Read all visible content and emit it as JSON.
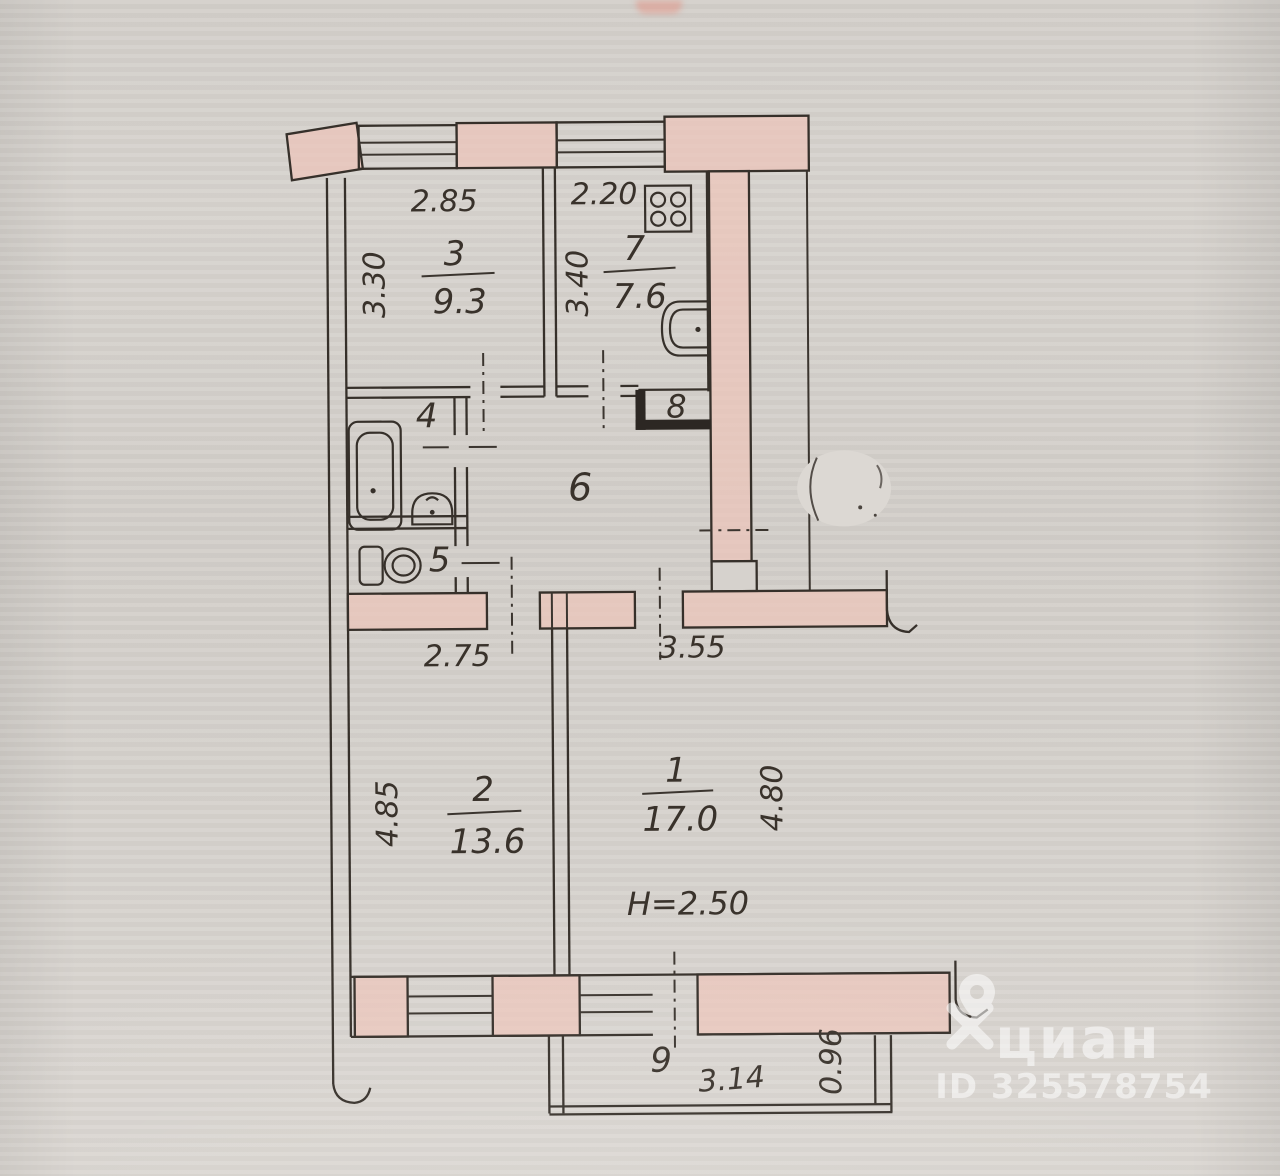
{
  "plan": {
    "rooms": {
      "room_1": {
        "number": "1",
        "area": "17.0",
        "width": "3.55",
        "depth": "4.80",
        "ceiling_height": "H=2.50"
      },
      "room_2": {
        "number": "2",
        "area": "13.6",
        "width": "2.75",
        "depth": "4.85"
      },
      "room_3": {
        "number": "3",
        "area": "9.3",
        "width": "2.85",
        "depth": "3.30"
      },
      "bathroom_4": {
        "number": "4"
      },
      "toilet_5": {
        "number": "5"
      },
      "hallway_6": {
        "number": "6"
      },
      "kitchen_7": {
        "number": "7",
        "area": "7.6",
        "width": "2.20",
        "depth": "3.40"
      },
      "closet_8": {
        "number": "8"
      },
      "balcony_9": {
        "number": "9",
        "width": "3.14",
        "depth": "0.96"
      }
    }
  },
  "watermark": {
    "brand": "циан",
    "id": "ID 325578754"
  }
}
